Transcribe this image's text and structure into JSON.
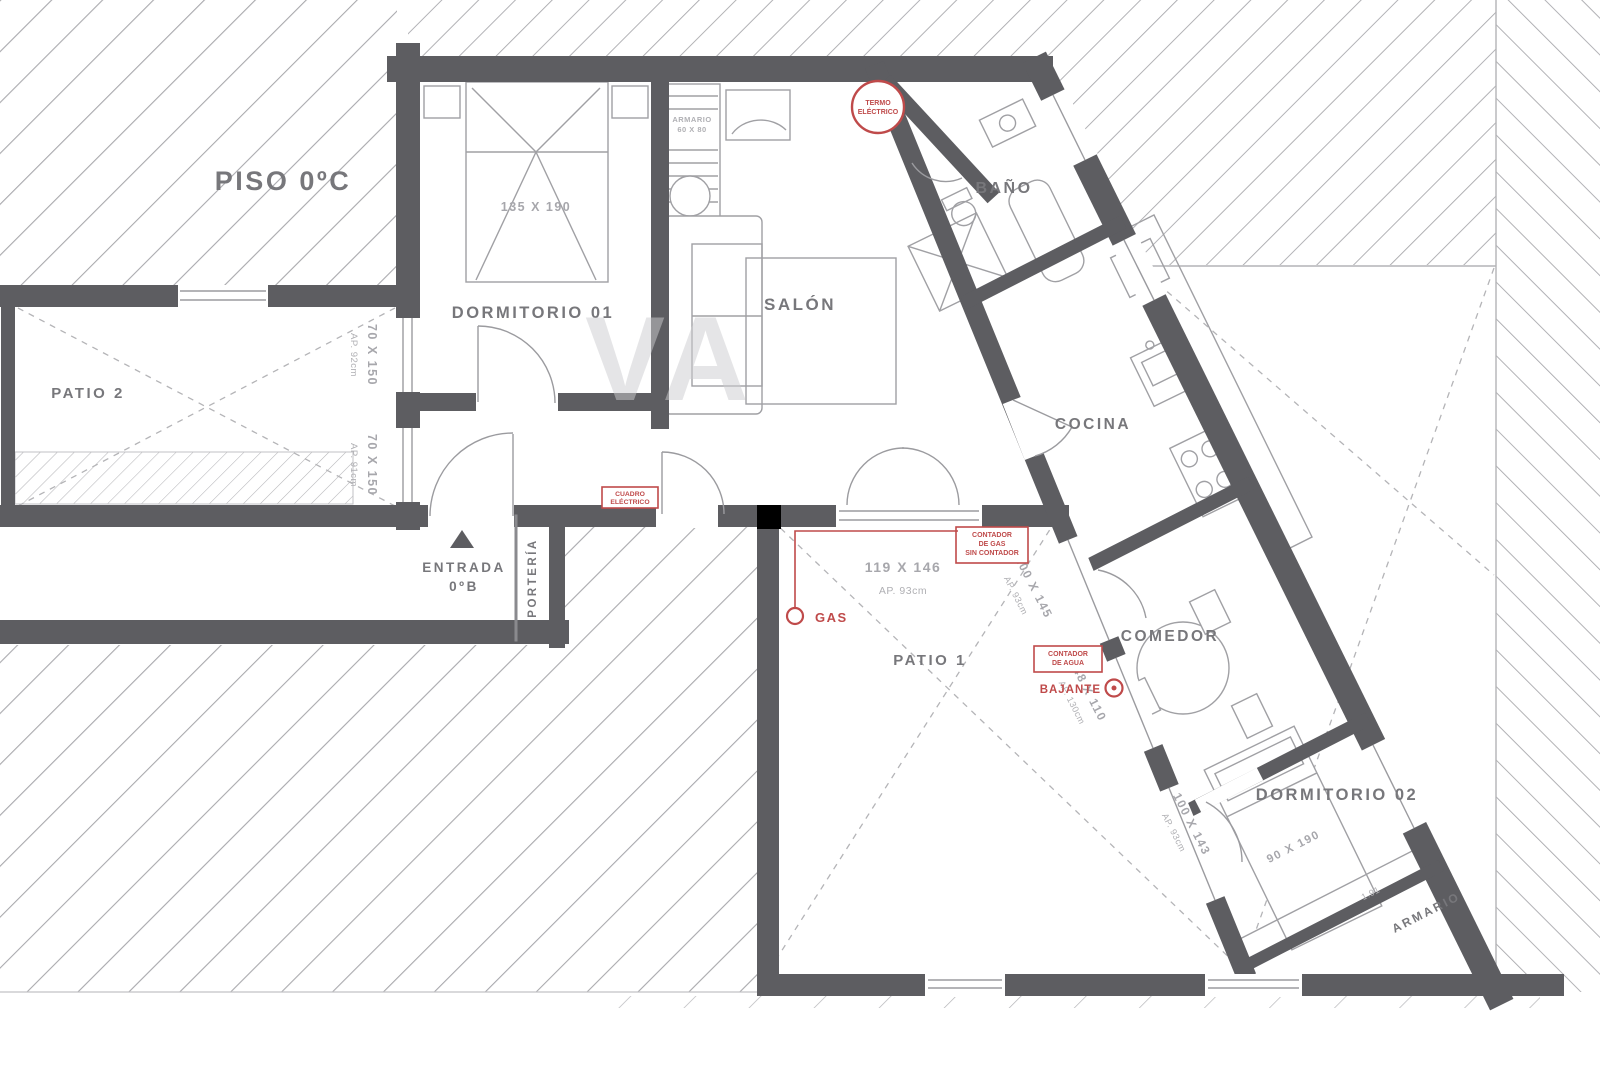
{
  "title": "PISO 0ºC",
  "watermark": "VA",
  "colors": {
    "wall": "#5d5d61",
    "red": "#bf4a4a",
    "label": "#77777b",
    "dim": "#a7a7ac",
    "hatch": "#a9a9ad"
  },
  "rooms": {
    "dormitorio1": "DORMITORIO 01",
    "salon": "SALÓN",
    "bano": "BAÑO",
    "cocina": "COCINA",
    "comedor": "COMEDOR",
    "dormitorio2": "DORMITORIO 02",
    "patio1": "PATIO 1",
    "patio2": "PATIO 2",
    "porteria": "PORTERÍA",
    "armario": "ARMARIO",
    "entrada_line1": "ENTRADA",
    "entrada_line2": "0ºB"
  },
  "furniture": {
    "bed1_size": "135 X 190",
    "bed2_size": "90 X 190",
    "closet_line1": "ARMARIO",
    "closet_line2": "60 X 80",
    "armario_length": "1.91"
  },
  "windows": {
    "w1_size": "70 X 150",
    "w1_ap": "AP. 92cm",
    "w2_size": "70 X 150",
    "w2_ap": "AP. 91cm",
    "w3_size": "119 X 146",
    "w3_ap": "AP. 93cm",
    "w4_size": "100 X 145",
    "w4_ap": "AP. 93cm",
    "w5_size": "48 X 110",
    "w5_ap": "AP. 130cm",
    "w6_size": "100 X 143",
    "w6_ap": "AP. 93cm"
  },
  "annotations": {
    "termo1": "TERMO",
    "termo2": "ELÉCTRICO",
    "cuadro1": "CUADRO",
    "cuadro2": "ELÉCTRICO",
    "cgas1": "CONTADOR",
    "cgas2": "DE GAS",
    "cgas3": "SIN CONTADOR",
    "gas": "GAS",
    "cagua1": "CONTADOR",
    "cagua2": "DE AGUA",
    "bajante": "BAJANTE"
  }
}
